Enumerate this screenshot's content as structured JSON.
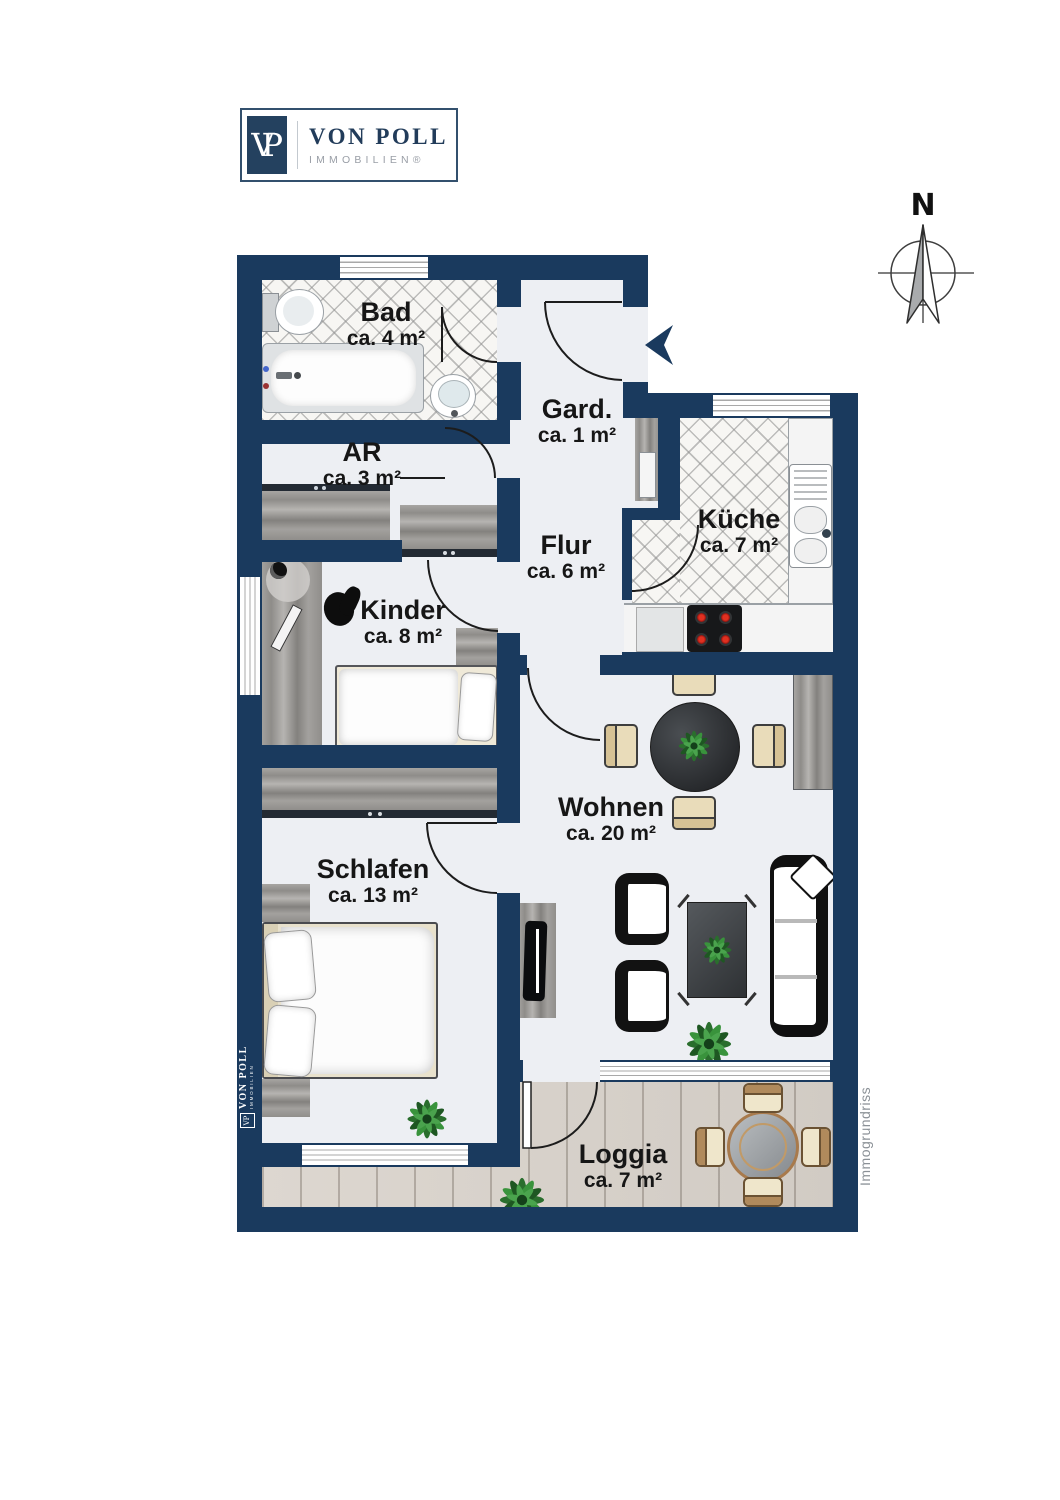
{
  "brand": {
    "monogram_v": "V",
    "monogram_p": "P",
    "name": "VON POLL",
    "subtitle": "IMMOBILIEN®"
  },
  "compass": {
    "north_label": "N"
  },
  "rooms": {
    "bad": {
      "name": "Bad",
      "area": "ca. 4 m²"
    },
    "ar": {
      "name": "AR",
      "area": "ca. 3 m²"
    },
    "gard": {
      "name": "Gard.",
      "area": "ca. 1 m²"
    },
    "kueche": {
      "name": "Küche",
      "area": "ca. 7 m²"
    },
    "flur": {
      "name": "Flur",
      "area": "ca. 6 m²"
    },
    "kinder": {
      "name": "Kinder",
      "area": "ca. 8 m²"
    },
    "wohnen": {
      "name": "Wohnen",
      "area": "ca. 20 m²"
    },
    "schlafen": {
      "name": "Schlafen",
      "area": "ca. 13 m²"
    },
    "loggia": {
      "name": "Loggia",
      "area": "ca. 7 m²"
    }
  },
  "watermarks": {
    "wall_logo_monogram": "VP",
    "wall_logo_name": "VON POLL",
    "wall_logo_subtitle": "IMMOBILIEN",
    "side_note": "Immogrundriss"
  },
  "colors": {
    "wall": "#1a3a5e",
    "floor": "#edeff3",
    "deck": "#d9d3cc",
    "accent_navy": "#24415f"
  }
}
